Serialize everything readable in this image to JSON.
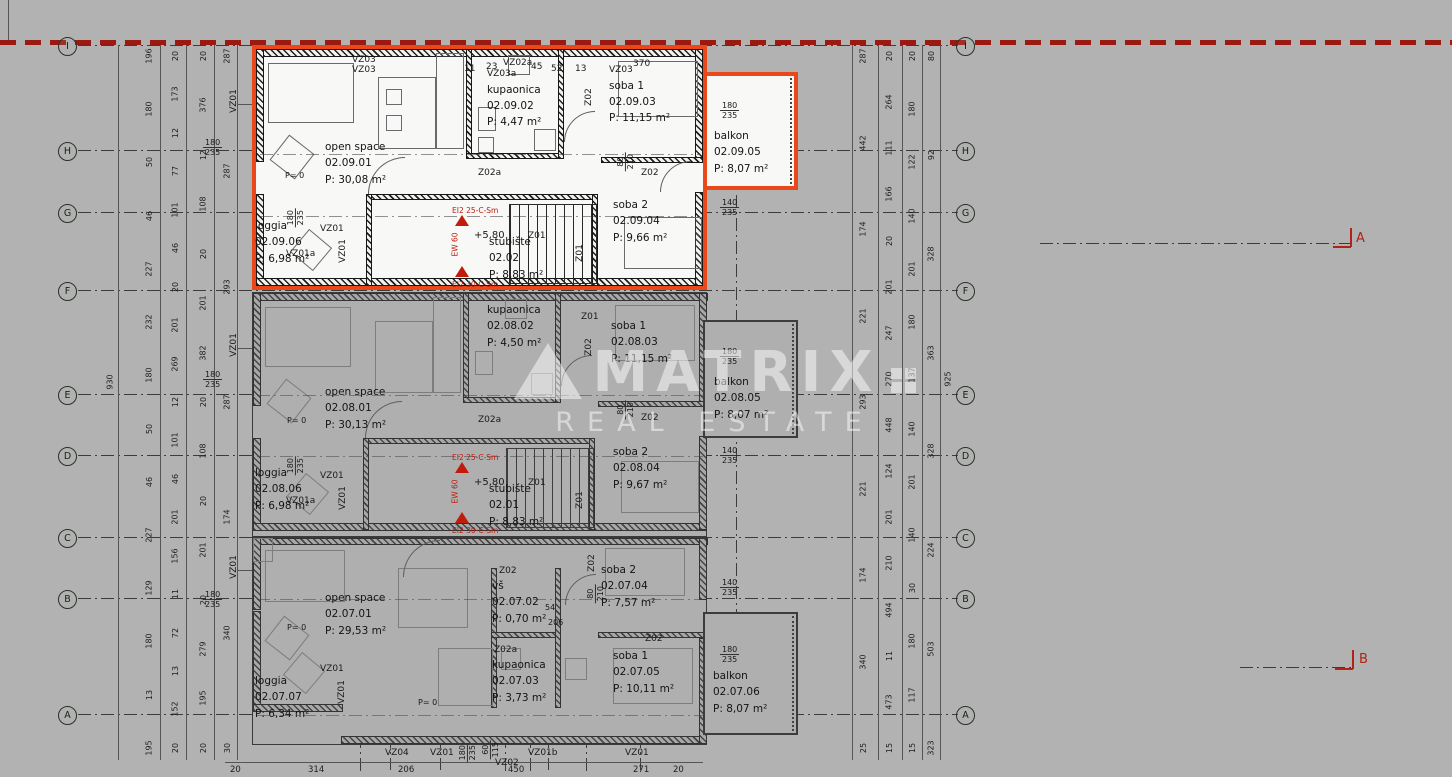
{
  "watermark": {
    "brand": "MATRIX",
    "subtitle": "REAL ESTATE"
  },
  "grid": {
    "letters": [
      "I",
      "H",
      "G",
      "F",
      "E",
      "D",
      "C",
      "B",
      "A"
    ]
  },
  "section_marks": {
    "a": "A",
    "b": "B"
  },
  "dims": {
    "top_row": [
      "11",
      "23",
      "45",
      "52",
      "13"
    ],
    "bottom_row": [
      "20",
      "314",
      "206",
      "450",
      "271",
      "20"
    ],
    "left_total": "930",
    "right_total": "925",
    "left_chains": [
      [
        "196",
        "180",
        "50",
        "46",
        "227",
        "232",
        "180",
        "50",
        "46",
        "227",
        "129",
        "180",
        "13",
        "195"
      ],
      [
        "20",
        "173",
        "12",
        "77",
        "101",
        "46",
        "20",
        "201",
        "269",
        "12",
        "101",
        "46",
        "201",
        "156",
        "11",
        "72",
        "13",
        "152",
        "20"
      ],
      [
        "20",
        "376",
        "12",
        "108",
        "20",
        "201",
        "382",
        "20",
        "108",
        "20",
        "201",
        "20",
        "279",
        "195",
        "20"
      ],
      [
        "287",
        "287",
        "293",
        "287",
        "174",
        "340",
        "30"
      ]
    ],
    "right_chains": [
      [
        "287",
        "442",
        "174",
        "221",
        "293",
        "221",
        "174",
        "340",
        "25"
      ],
      [
        "20",
        "264",
        "111",
        "166",
        "20",
        "201",
        "247",
        "270",
        "448",
        "124",
        "201",
        "210",
        "494",
        "11",
        "473",
        "15"
      ],
      [
        "20",
        "180",
        "122",
        "140",
        "201",
        "180",
        "137",
        "140",
        "201",
        "140",
        "30",
        "180",
        "117",
        "15"
      ],
      [
        "80",
        "92",
        "328",
        "363",
        "328",
        "224",
        "503",
        "323"
      ]
    ]
  },
  "tags": {
    "vz01": "VZ01",
    "vz01a": "VZ01a",
    "vz01b": "VZ01b",
    "vz02": "VZ02",
    "vz02a": "VZ02a",
    "vz03": "VZ03",
    "vz03a": "VZ03a",
    "vz04": "VZ04",
    "z01": "Z01",
    "z02": "Z02",
    "z02a": "Z02a",
    "w180": "180",
    "w235": "235",
    "w140": "140",
    "w60": "60",
    "w115": "115",
    "w80": "80",
    "w210": "210",
    "n370": "370",
    "n54": "54",
    "n206": "206",
    "p0": "P= 0"
  },
  "annotations": {
    "fire25": "EI2 25-C-Sm",
    "fire30": "EI2 30-C-Sm",
    "ew": "EW 60",
    "level": "+5,80"
  },
  "units": [
    {
      "open_space": {
        "name": "open space",
        "code": "02.09.01",
        "area": "P: 30,08 m²"
      },
      "kupaonica": {
        "name": "kupaonica",
        "code": "02.09.02",
        "area": "P: 4,47 m²"
      },
      "soba1": {
        "name": "soba 1",
        "code": "02.09.03",
        "area": "P: 11,15 m²"
      },
      "soba2": {
        "name": "soba 2",
        "code": "02.09.04",
        "area": "P: 9,66 m²"
      },
      "balkon": {
        "name": "balkon",
        "code": "02.09.05",
        "area": "P: 8,07 m²"
      },
      "loggia": {
        "name": "loggia",
        "code": "02.09.06",
        "area": "P: 6,98 m²"
      },
      "stair": {
        "name": "stubište",
        "code": "02.02",
        "area": "P: 8,83 m²"
      }
    },
    {
      "open_space": {
        "name": "open space",
        "code": "02.08.01",
        "area": "P: 30,13 m²"
      },
      "kupaonica": {
        "name": "kupaonica",
        "code": "02.08.02",
        "area": "P: 4,50 m²"
      },
      "soba1": {
        "name": "soba 1",
        "code": "02.08.03",
        "area": "P: 11,15 m²"
      },
      "soba2": {
        "name": "soba 2",
        "code": "02.08.04",
        "area": "P: 9,67 m²"
      },
      "balkon": {
        "name": "balkon",
        "code": "02.08.05",
        "area": "P: 8,07 m²"
      },
      "loggia": {
        "name": "loggia",
        "code": "02.08.06",
        "area": "P: 6,98 m²"
      },
      "stair": {
        "name": "stubište",
        "code": "02.01",
        "area": "P: 8,83 m²"
      }
    },
    {
      "open_space": {
        "name": "open space",
        "code": "02.07.01",
        "area": "P: 29,53 m²"
      },
      "vs": {
        "name": "vš",
        "code": "02.07.02",
        "area": "P: 0,70 m²"
      },
      "kupaonica": {
        "name": "kupaonica",
        "code": "02.07.03",
        "area": "P: 3,73 m²"
      },
      "soba2": {
        "name": "soba 2",
        "code": "02.07.04",
        "area": "P: 7,57 m²"
      },
      "soba1": {
        "name": "soba 1",
        "code": "02.07.05",
        "area": "P: 10,11 m²"
      },
      "balkon": {
        "name": "balkon",
        "code": "02.07.06",
        "area": "P: 8,07 m²"
      },
      "loggia": {
        "name": "loggia",
        "code": "02.07.07",
        "area": "P: 6,34 m²"
      }
    }
  ]
}
